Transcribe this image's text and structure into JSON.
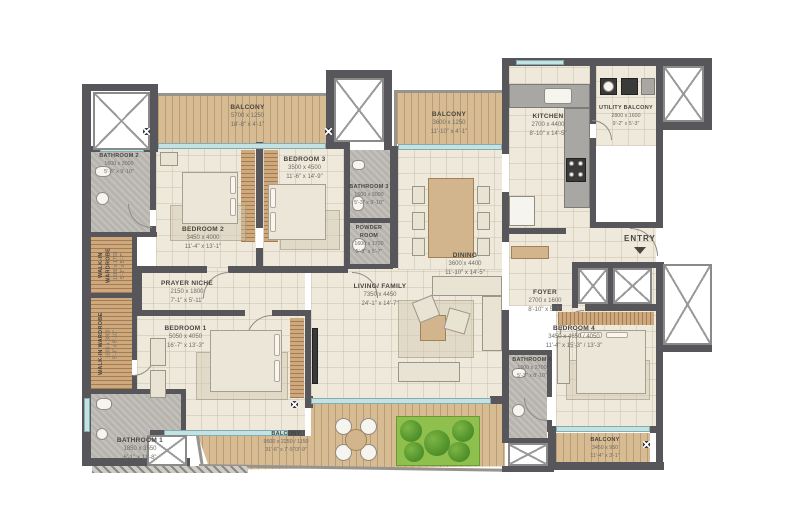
{
  "title": "Apartment Floor Plan",
  "colors": {
    "wall": "#57565a",
    "floor": "#efe9dc",
    "bath_tile": "#b7b3ad",
    "wood_deck": "#d7bb93",
    "glass": "#c3e2e4",
    "planter_green": "#8fbf4d",
    "text": "#474540"
  },
  "rooms": {
    "balcony_tl": {
      "name": "BALCONY",
      "mm": "5700 x 1250",
      "ft": "18'-8\" x 4'-1\""
    },
    "bathroom2": {
      "name": "BATHROOM 2",
      "mm": "1600 x 3000",
      "ft": "5'-3\" x 9'-10\""
    },
    "bedroom2": {
      "name": "BEDROOM 2",
      "mm": "3450 x 4000",
      "ft": "11'-4\" x 13'-1\""
    },
    "bedroom3": {
      "name": "BEDROOM 3",
      "mm": "3500 x 4500",
      "ft": "11'-6\" x 14'-9\""
    },
    "wardrobe_upper": {
      "name": "WALK-IN WARDROBE",
      "mm": "1600 x 1700",
      "ft": "5'-3\" x 5'-7\""
    },
    "bathroom3": {
      "name": "BATHROOM 3",
      "mm": "1600 x 3000",
      "ft": "5'-3\" x 9'-10\""
    },
    "powder": {
      "name": "POWDER ROOM",
      "mm": "1600 x 1700",
      "ft": "5'-3\" x 5'-7\""
    },
    "balcony_tc": {
      "name": "BALCONY",
      "mm": "3600 x 1250",
      "ft": "11'-10\" x 4'-1\""
    },
    "dining": {
      "name": "DINING",
      "mm": "3600 x 4400",
      "ft": "11'-10\" x 14'-5\""
    },
    "kitchen": {
      "name": "KITCHEN",
      "mm": "2700 x 4400",
      "ft": "8'-10\" x 14'-5\""
    },
    "utility": {
      "name": "UTILITY BALCONY",
      "mm": "2800 x 1600",
      "ft": "9'-2\" x 5'-3\""
    },
    "entry": {
      "name": "ENTRY"
    },
    "foyer": {
      "name": "FOYER",
      "mm": "2700 x 1600",
      "ft": "8'-10\" x 5'-3\""
    },
    "bedroom4": {
      "name": "BEDROOM 4",
      "mm": "3450 x 4650 / 4050",
      "ft": "11'-4\" x 15'-3\" / 13'-3\""
    },
    "bathroom4": {
      "name": "BATHROOM 4",
      "mm": "1600 x 2700",
      "ft": "5'-3\" x 8'-10\""
    },
    "balcony_br": {
      "name": "BALCONY",
      "mm": "3450 x 950",
      "ft": "11'-4\" x 3'-1\""
    },
    "prayer": {
      "name": "PRAYER NICHE",
      "mm": "2150 x 1800",
      "ft": "7'-1\" x 5'-11\""
    },
    "bedroom1": {
      "name": "BEDROOM 1",
      "mm": "5050 x 4050",
      "ft": "16'-7\" x 13'-3\""
    },
    "wardrobe_lower": {
      "name": "WALK-IN WARDROBE",
      "mm": "1600 x 3000",
      "ft": "5'-3\" x 9'-10\""
    },
    "bathroom1": {
      "name": "BATHROOM 1",
      "mm": "1850 x 3550",
      "ft": "6'-1\" x 11'-8\""
    },
    "living": {
      "name": "LIVING/ FAMILY",
      "mm": "7350 x 4450",
      "ft": "24'-1\" x 14'-7\""
    },
    "balcony_b": {
      "name": "BALCONY",
      "mm": "9600 x 2250 / 1150",
      "ft": "31'-6\" x 7'-5\"/3'-9\""
    }
  }
}
